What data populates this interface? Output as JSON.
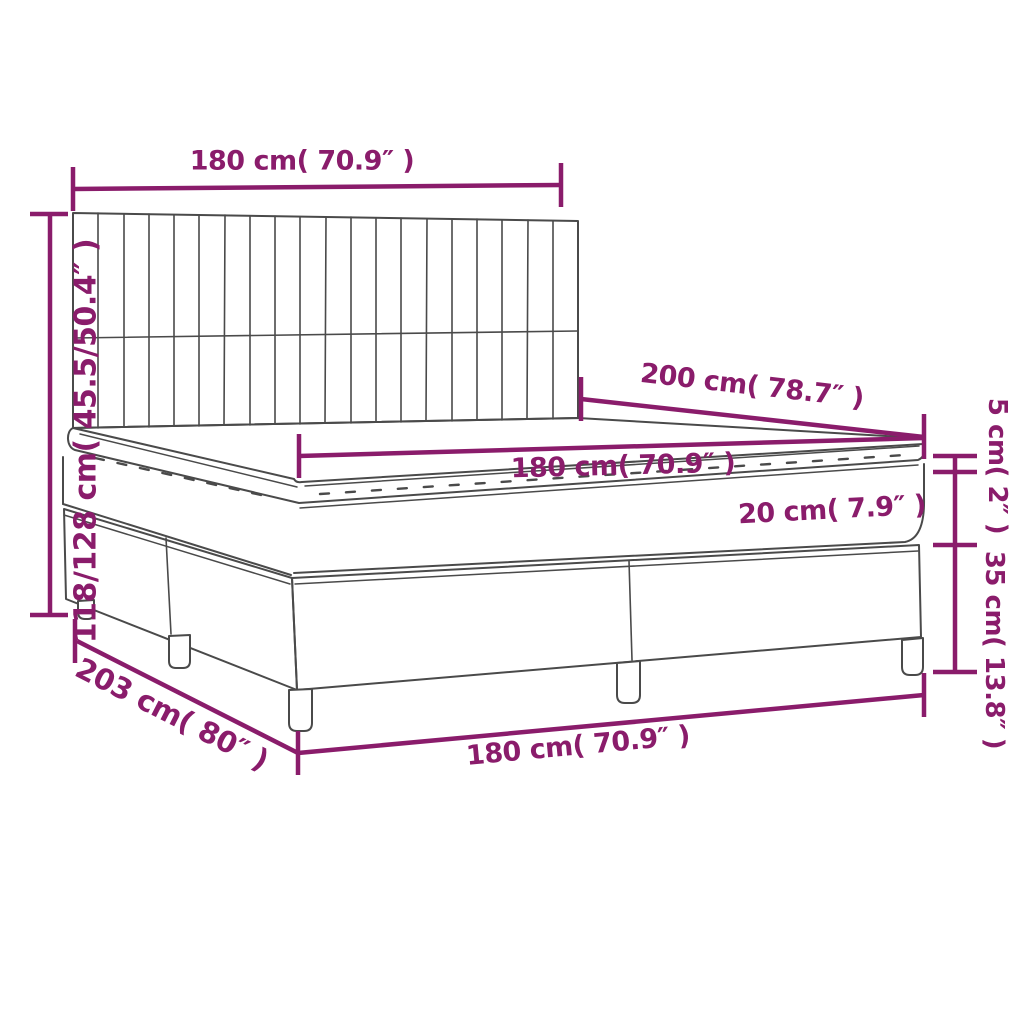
{
  "diagram": {
    "subject": "box spring bed with mattress and topper",
    "colors": {
      "dimension_accent": "#8a1c6b",
      "line_art": "#4a4a4a",
      "background": "#ffffff"
    }
  },
  "dimension_labels": {
    "headboard_width": "180 cm( 70.9″ )",
    "bed_height": "118/128 cm( 45.5/50.4″ )",
    "bed_length": "200 cm( 78.7″ )",
    "mattress_width": "180 cm( 70.9″ )",
    "mattress_thickness": "20 cm( 7.9″ )",
    "topper_thickness": "5 cm( 2″ )",
    "base_height": "35 cm( 13.8″ )",
    "total_length": "203 cm( 80″ )",
    "base_width": "180 cm( 70.9″ )"
  }
}
